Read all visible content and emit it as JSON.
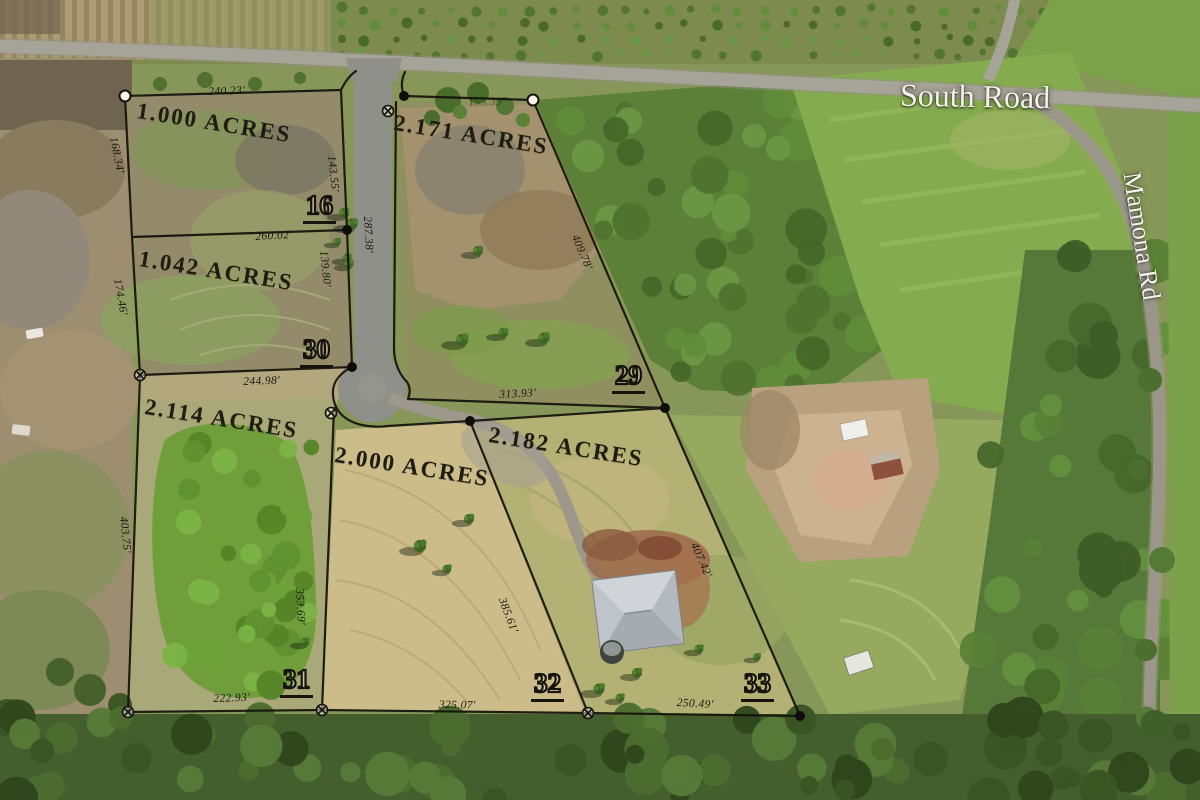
{
  "map": {
    "road_labels": {
      "south": "South Road",
      "mamona": "Mamona Rd"
    },
    "lots": [
      {
        "number": "16",
        "acreage": "1.000 ACRES"
      },
      {
        "number": "30",
        "acreage": "1.042 ACRES"
      },
      {
        "number": "31",
        "acreage": "2.114 ACRES"
      },
      {
        "number": "29",
        "acreage": "2.171 ACRES"
      },
      {
        "number": "32",
        "acreage": "2.000 ACRES"
      },
      {
        "number": "33",
        "acreage": "2.182 ACRES"
      }
    ],
    "dimensions": [
      {
        "text": "240.23'"
      },
      {
        "text": "168.34'"
      },
      {
        "text": "143.55'"
      },
      {
        "text": "155.39'"
      },
      {
        "text": "287.38'"
      },
      {
        "text": "260.02'"
      },
      {
        "text": "174.46'"
      },
      {
        "text": "139.80'"
      },
      {
        "text": "244.98'"
      },
      {
        "text": "403.75'"
      },
      {
        "text": "409.78'"
      },
      {
        "text": "313.93'"
      },
      {
        "text": "353.69'"
      },
      {
        "text": "385.61'"
      },
      {
        "text": "222.93'"
      },
      {
        "text": "325.07'"
      },
      {
        "text": "250.49'"
      },
      {
        "text": "407.42'"
      }
    ],
    "colors": {
      "boundary_line": "#14130c",
      "survey_text": "#1b1910",
      "road_label_text": "#f4f1ea"
    }
  }
}
